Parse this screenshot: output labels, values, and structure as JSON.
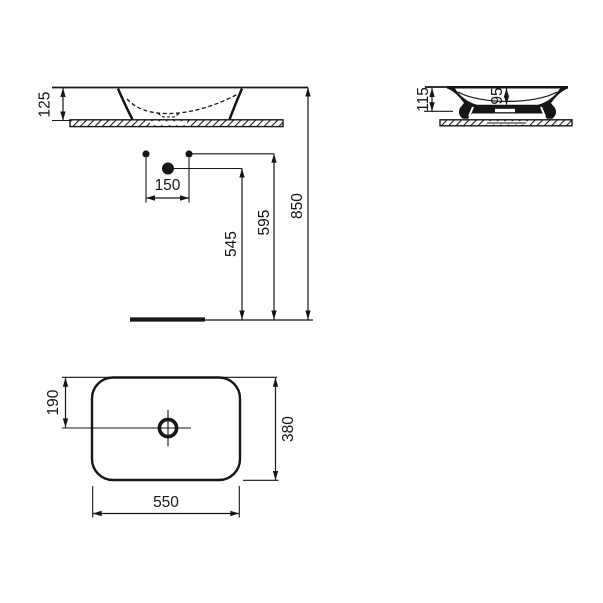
{
  "drawing": {
    "title": "basin technical drawing",
    "line_color": "#161616",
    "background": "#ffffff",
    "front_elevation": {
      "dims": {
        "basin_height": "125"
      }
    },
    "side_section": {
      "dims": {
        "total_height": "115",
        "bowl_depth": "95"
      }
    },
    "installation_heights": {
      "dims": {
        "tap_spacing": "150",
        "drain_height": "545",
        "supply_height": "595",
        "rim_height": "850"
      }
    },
    "plan_view": {
      "dims": {
        "drain_offset": "190",
        "depth": "380",
        "width": "550"
      }
    }
  }
}
